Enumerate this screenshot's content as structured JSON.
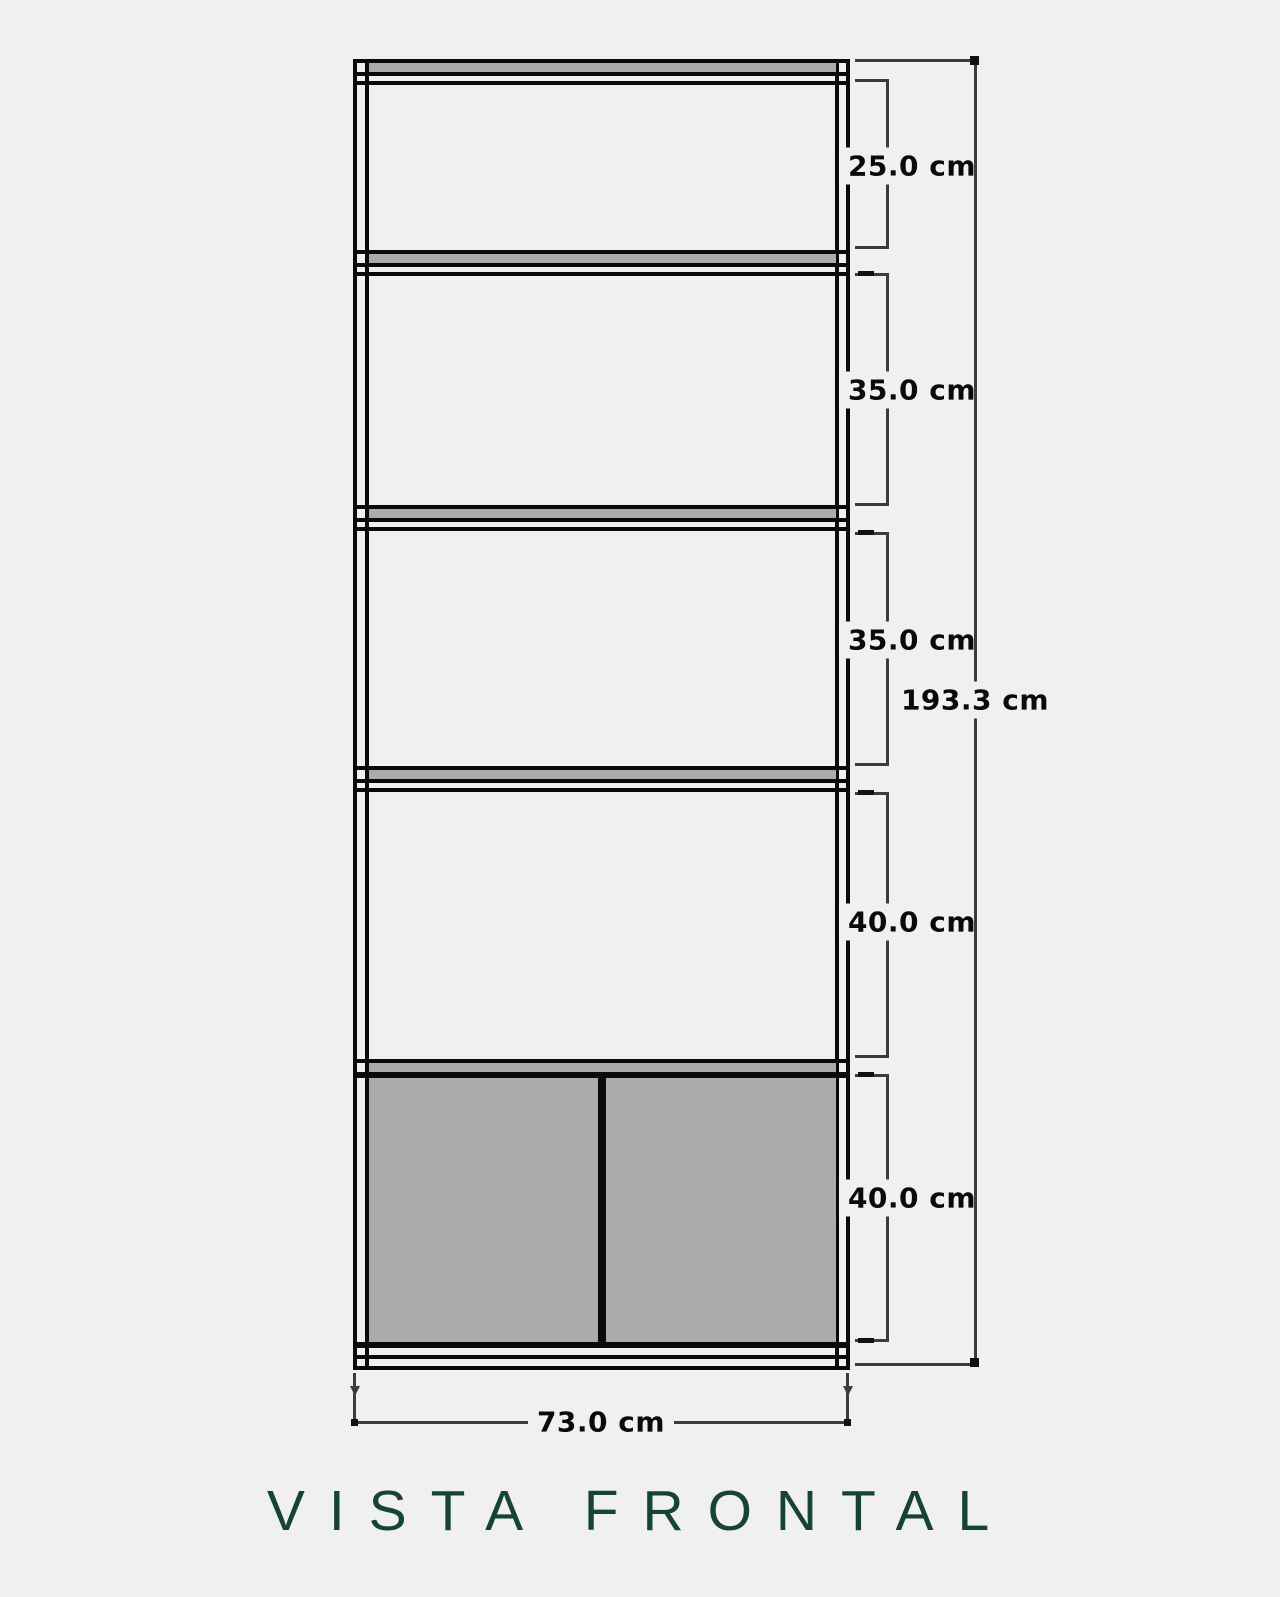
{
  "title": {
    "text": "VISTA FRONTAL"
  },
  "drawing": {
    "type": "furniture-front-elevation",
    "unit": "cm",
    "compartment_heights_cm": [
      25.0,
      35.0,
      35.0,
      40.0,
      40.0
    ],
    "total_height_cm": 193.3,
    "width_cm": 73.0,
    "shelf_count": 4,
    "door_count": 2
  },
  "labels": {
    "segments": [
      "25.0 cm",
      "35.0 cm",
      "35.0 cm",
      "40.0 cm",
      "40.0 cm"
    ],
    "total": "193.3 cm",
    "width": "73.0 cm"
  },
  "colors": {
    "background": "#f0f1ef",
    "cabinet_line": "#0a0a0a",
    "dimension_line": "#3c3c3c",
    "panel_gray": "#ababab",
    "title": "#17423a"
  }
}
